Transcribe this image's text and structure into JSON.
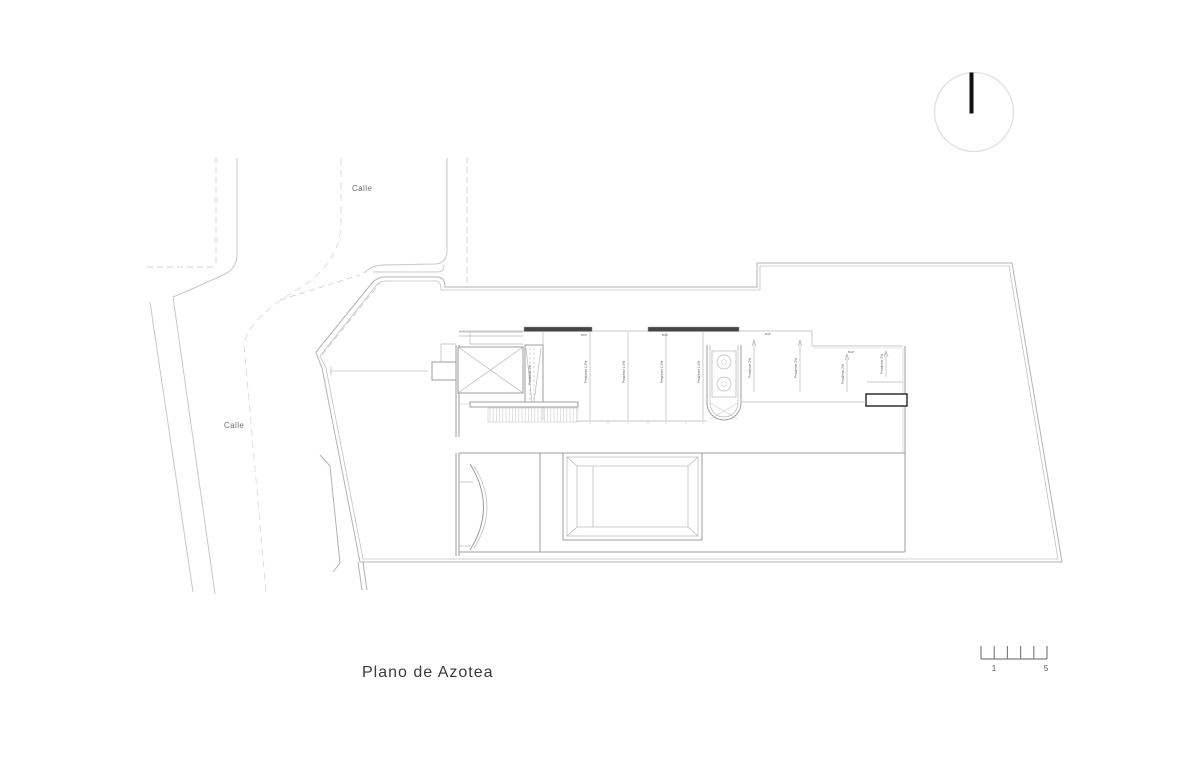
{
  "drawing": {
    "title": "Plano de Azotea",
    "street_label_top": "Calle",
    "street_label_left": "Calle",
    "scale_bar": {
      "label_start": "1",
      "label_end": "5"
    },
    "slope_labels": [
      {
        "text": "Pendiente 2%"
      },
      {
        "text": "Pendiente 1.5%"
      },
      {
        "text": "Pendiente 1.5%"
      },
      {
        "text": "Pendiente 1.5%"
      },
      {
        "text": "Pendiente 1.5%"
      },
      {
        "text": "Pendiente 2%"
      },
      {
        "text": "Pendiente 2%"
      },
      {
        "text": "Pendiente 2%"
      },
      {
        "text": "Pendiente 2%"
      }
    ],
    "drain_labels": [
      {
        "text": "BAP"
      },
      {
        "text": "BAP"
      },
      {
        "text": "BAP"
      },
      {
        "text": "BAP"
      }
    ],
    "colors": {
      "background": "#ffffff",
      "street_line": "#c9c9c9",
      "boundary_line": "#b3b3b3",
      "building_line": "#9c9c9c",
      "beam_fill": "#454545",
      "equipment_outline": "#2f2f2f",
      "north_circle": "#e0e0e0",
      "title_text": "#3a3a3a"
    }
  }
}
